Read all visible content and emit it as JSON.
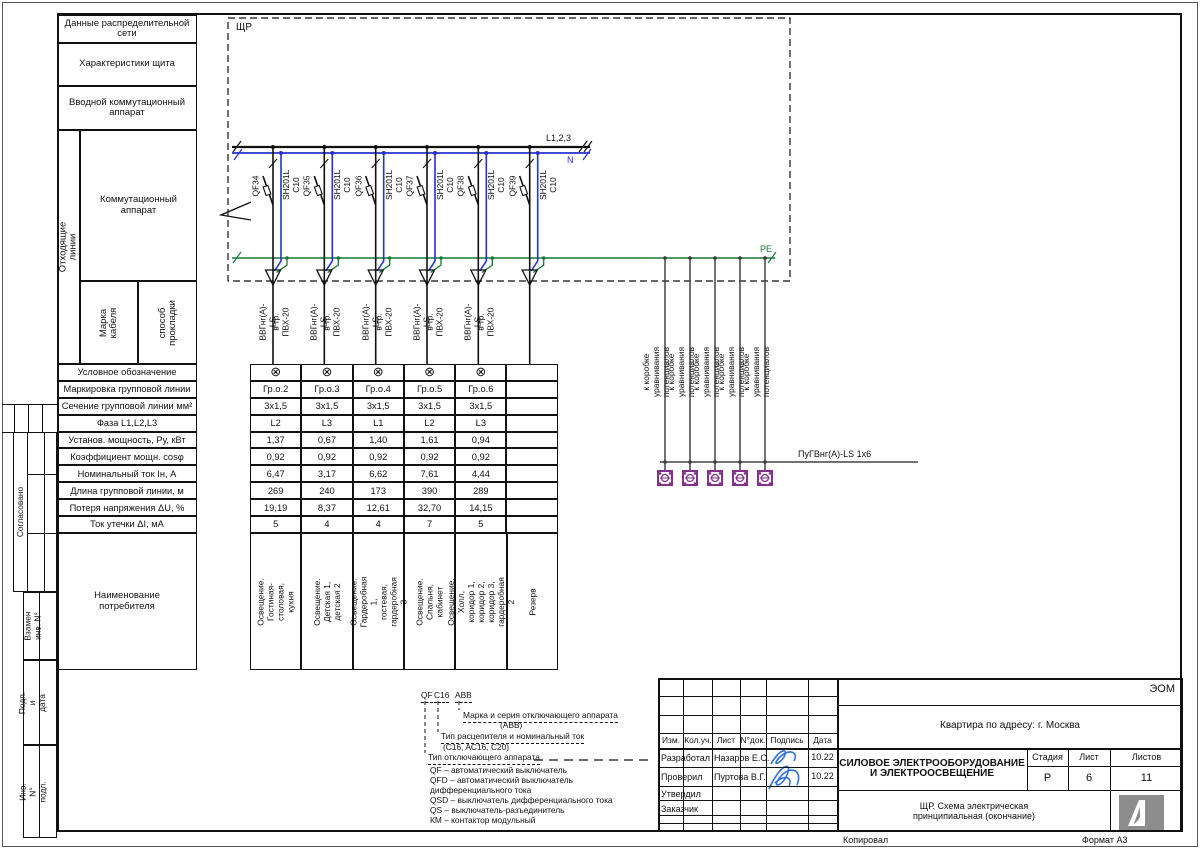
{
  "colors": {
    "neutral": "#2433cc",
    "pe_green": "#157a37",
    "bonding_purple": "#83308a",
    "signature_blue": "#2f72d8"
  },
  "margin": {
    "agreed": "Согласовано",
    "replace_inv": "Взамен инв. N°",
    "sign_date": "Подп. и дата",
    "inv_orig": "Инв. N° подл."
  },
  "footer": {
    "copied": "Копировал",
    "format": "Формат А3"
  },
  "sidebar": {
    "net_data": "Данные распределительной\nсети",
    "panel_chars": "Характеристики щита",
    "input_switch": "Вводной коммутационный\nаппарат",
    "outgoing": "Отходящие линии",
    "switching": "Коммутационный\nаппарат",
    "cable_brand": "Марка кабеля",
    "laying": "способ\nпрокладки",
    "param_rows": [
      "Условное обозначение",
      "Маркировка групповой линии",
      "Сечение групповой линии мм²",
      "Фаза L1,L2,L3",
      "Установ. мощность, Ру, кВт",
      "Коэффициент мощн. cosφ",
      "Номинальный ток Iн, А",
      "Длина групповой линии, м",
      "Потеря напряжения ΔU, %",
      "Ток утечки ΔI, мА"
    ],
    "consumer": "Наименование\nпотребителя"
  },
  "schematic": {
    "panel_label": "ЩР",
    "bus_label": "L1,2,3",
    "n_label": "N",
    "pe_label": "PE",
    "breakers": [
      {
        "id": "QF34",
        "type": "SH201L C10"
      },
      {
        "id": "QF35",
        "type": "SH201L C10"
      },
      {
        "id": "QF36",
        "type": "SH201L C10"
      },
      {
        "id": "QF37",
        "type": "SH201L C10"
      },
      {
        "id": "QF38",
        "type": "SH201L C10"
      },
      {
        "id": "QF39",
        "type": "SH201L C10"
      }
    ],
    "cable_line1": "ВВГнг(А)-LS",
    "cable_line2": "в тр. ПВХ-20",
    "bonding_label": "к коробке уравнивания потенциалов",
    "pe_wire_label": "ПуГВнг(А)-LS 1x6"
  },
  "table": {
    "columns": [
      {
        "symbol": "⊗",
        "group": "Гр.о.2",
        "section": "3x1,5",
        "phase": "L2",
        "power": "1,37",
        "cos": "0,92",
        "current": "6,47",
        "length": "269",
        "loss": "19,19",
        "leak": "5",
        "consumer": "Освещение.\nГостиная-столовая, кухня"
      },
      {
        "symbol": "⊗",
        "group": "Гр.о.3",
        "section": "3x1,5",
        "phase": "L3",
        "power": "0,67",
        "cos": "0,92",
        "current": "3,17",
        "length": "240",
        "loss": "8,37",
        "leak": "4",
        "consumer": "Освещение. Детская 1,\nдетская 2"
      },
      {
        "symbol": "⊗",
        "group": "Гр.о.4",
        "section": "3x1,5",
        "phase": "L1",
        "power": "1,40",
        "cos": "0,92",
        "current": "6,62",
        "length": "173",
        "loss": "12,61",
        "leak": "4",
        "consumer": "Освещение. Гардеробная 1,\nгостевая, гардеробная 3"
      },
      {
        "symbol": "⊗",
        "group": "Гр.о.5",
        "section": "3x1,5",
        "phase": "L2",
        "power": "1,61",
        "cos": "0,92",
        "current": "7,61",
        "length": "390",
        "loss": "32,70",
        "leak": "7",
        "consumer": "Освещение. Спальня,\nкабинет"
      },
      {
        "symbol": "⊗",
        "group": "Гр.о.6",
        "section": "3x1,5",
        "phase": "L3",
        "power": "0,94",
        "cos": "0,92",
        "current": "4,44",
        "length": "289",
        "loss": "14,15",
        "leak": "5",
        "consumer": "Освещение. Холл, коридор 1,\nкоридор 2, коридор 3,\nгардеробная 2"
      },
      {
        "symbol": "",
        "group": "",
        "section": "",
        "phase": "",
        "power": "",
        "cos": "",
        "current": "",
        "length": "",
        "loss": "",
        "leak": "",
        "consumer": "Резерв"
      }
    ]
  },
  "legend": {
    "tok_qf": "QF",
    "tok_c16": "C16",
    "tok_abb": "ABB",
    "brand_line": "Марка и серия отключающего аппарата",
    "brand_sub": "(ABB)",
    "trip_line": "Тип расцепителя и номинальный ток",
    "trip_sub": "(C16, AC16, C20)",
    "type_line": "Тип отключающего аппарата",
    "items": [
      "QF – автоматический выключатель",
      "QFD – автоматический выключатель",
      "дифференциального тока",
      "QSD – выключатель дифференциального тока",
      "QS – выключатель-разъединитель",
      "КМ – контактор модульный"
    ]
  },
  "titleblock": {
    "code": "ЭОМ",
    "address": "Квартира по адресу: г. Москва",
    "cols": [
      "Изм.",
      "Кол.уч.",
      "Лист",
      "N°док.",
      "Подпись",
      "Дата"
    ],
    "rows": [
      {
        "role": "Разработал",
        "name": "Назаров Е.С.",
        "date": "10.22"
      },
      {
        "role": "Проверил",
        "name": "Пуртова В.Г.",
        "date": "10.22"
      },
      {
        "role": "Утвердил",
        "name": "",
        "date": ""
      },
      {
        "role": "Заказчик",
        "name": "",
        "date": ""
      }
    ],
    "title_main": "СИЛОВОЕ ЭЛЕКТРООБОРУДОВАНИЕ\nИ ЭЛЕКТРООСВЕЩЕНИЕ",
    "stage_label": "Стадия",
    "sheet_label": "Лист",
    "sheets_label": "Листов",
    "stage": "Р",
    "sheet": "6",
    "sheets": "11",
    "subtitle": "ЩР. Схема электрическая\nпринципиальная (окончание)"
  }
}
